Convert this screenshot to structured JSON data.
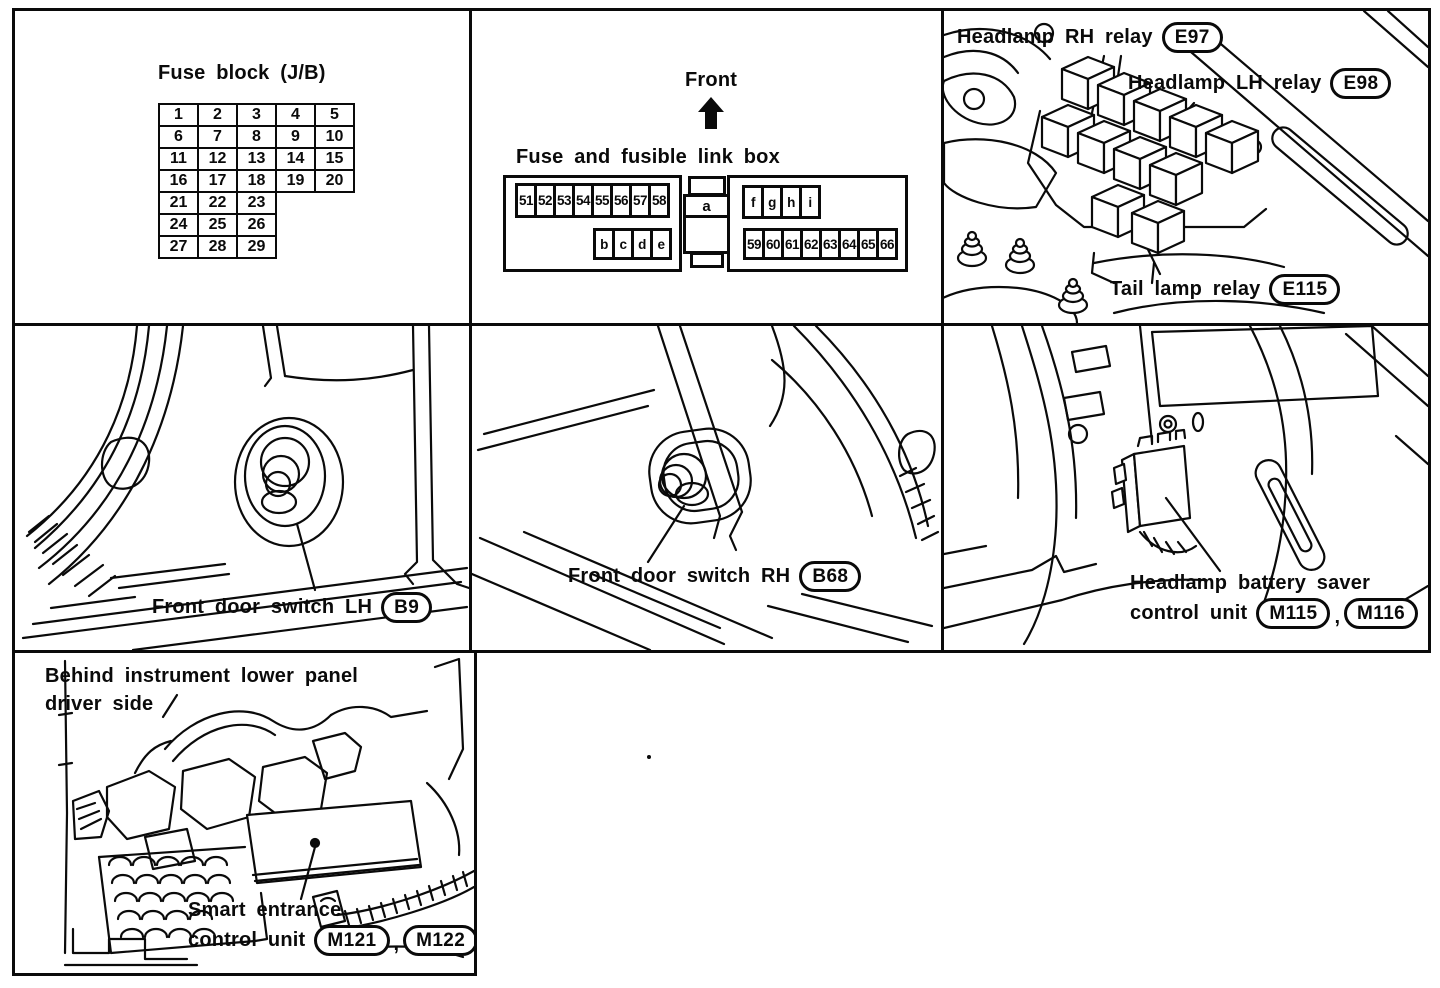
{
  "panels": {
    "fuse_block": {
      "title": "Fuse block (J/B)",
      "rows": [
        [
          "1",
          "2",
          "3",
          "4",
          "5"
        ],
        [
          "6",
          "7",
          "8",
          "9",
          "10"
        ],
        [
          "11",
          "12",
          "13",
          "14",
          "15"
        ],
        [
          "16",
          "17",
          "18",
          "19",
          "20"
        ],
        [
          "21",
          "22",
          "23"
        ],
        [
          "24",
          "25",
          "26"
        ],
        [
          "27",
          "28",
          "29"
        ]
      ]
    },
    "fuse_link_box": {
      "direction_label": "Front",
      "title": "Fuse and fusible link box",
      "left_top_cells": [
        "51",
        "52",
        "53",
        "54",
        "55",
        "56",
        "57",
        "58"
      ],
      "left_bottom_cells": [
        "b",
        "c",
        "d",
        "e"
      ],
      "center_cell": "a",
      "right_top_cells": [
        "f",
        "g",
        "h",
        "i"
      ],
      "right_bottom_cells": [
        "59",
        "60",
        "61",
        "62",
        "63",
        "64",
        "65",
        "66"
      ]
    },
    "engine_relays": {
      "labels": [
        {
          "text": "Headlamp RH relay",
          "code": "E97"
        },
        {
          "text": "Headlamp LH relay",
          "code": "E98"
        },
        {
          "text": "Tail lamp relay",
          "code": "E115"
        }
      ]
    },
    "door_switch_lh": {
      "text": "Front door switch LH",
      "code": "B9"
    },
    "door_switch_rh": {
      "text": "Front door switch RH",
      "code": "B68"
    },
    "battery_saver": {
      "line1": "Headlamp battery saver",
      "line2": "control unit",
      "codes": [
        "M115",
        "M116"
      ],
      "separator": ","
    },
    "smart_entrance": {
      "note1": "Behind instrument lower panel",
      "note2": "driver side",
      "line1": "Smart entrance",
      "line2": "control unit",
      "codes": [
        "M121",
        "M122"
      ],
      "separator": ","
    }
  }
}
